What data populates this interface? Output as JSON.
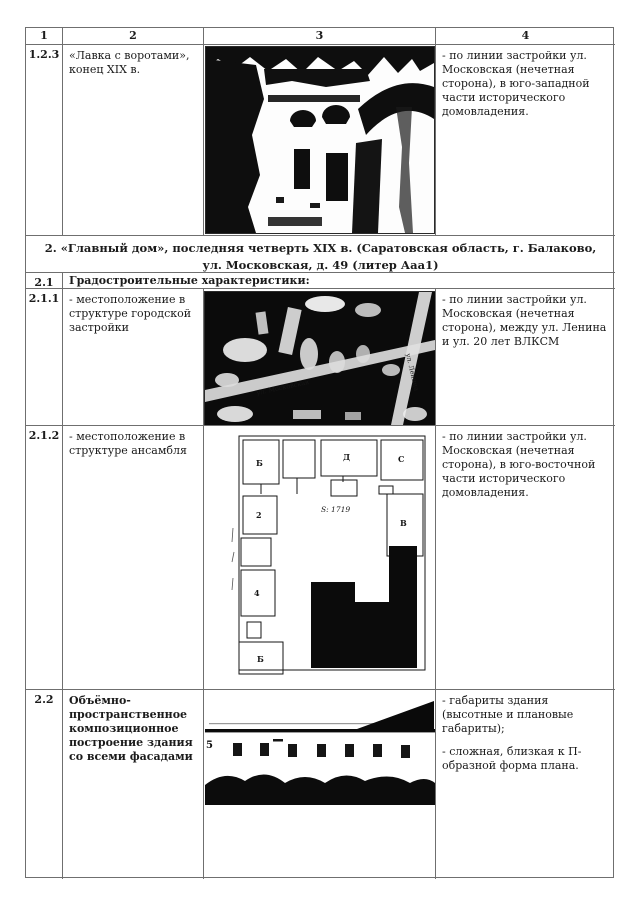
{
  "doc": {
    "columns": [
      "1",
      "2",
      "3",
      "4"
    ],
    "row_123": {
      "num": "1.2.3",
      "label": "«Лавка с воротами», конец XIX в.",
      "desc": "- по линии застройки ул. Московская (нечетная сторона), в юго-западной части исторического домовладения."
    },
    "section2": {
      "title": "2. «Главный дом», последняя четверть XIX в. (Саратовская область, г. Балаково, ул. Московская, д. 49 (литер Ааа1)"
    },
    "row_21": {
      "num": "2.1",
      "label": "Градостроительные характеристики:"
    },
    "row_211": {
      "num": "2.1.1",
      "label": "- местоположение в структуре городской застройки",
      "desc": "- по линии застройки ул. Московская (нечетная сторона), между ул. Ленина и ул. 20 лет ВЛКСМ"
    },
    "row_212": {
      "num": "2.1.2",
      "label": "- местоположение в структуре ансамбля",
      "desc": "- по линии застройки ул. Московская (нечетная сторона), в юго-восточной части исторического домовладения."
    },
    "row_22": {
      "num": "2.2",
      "label": "Объёмно-пространственное композиционное построение  здания  со всеми фасадами",
      "desc1": "- габариты здания (высотные и плановые габариты);",
      "desc2": "- сложная, близкая к П-образной форма плана."
    }
  },
  "images": {
    "map": {
      "street1": "ул. Московская",
      "street2": "ул. Ленина"
    },
    "plan": {
      "area_label": "S: 1719",
      "room_labels": [
        "Б",
        "Д",
        "С",
        "2",
        "4",
        "В",
        "Б"
      ]
    },
    "facade": {
      "mark": "5"
    }
  },
  "colors": {
    "text": "#1b1b1b",
    "border": "#6f6f6f",
    "ink": "#0d0d0d"
  }
}
